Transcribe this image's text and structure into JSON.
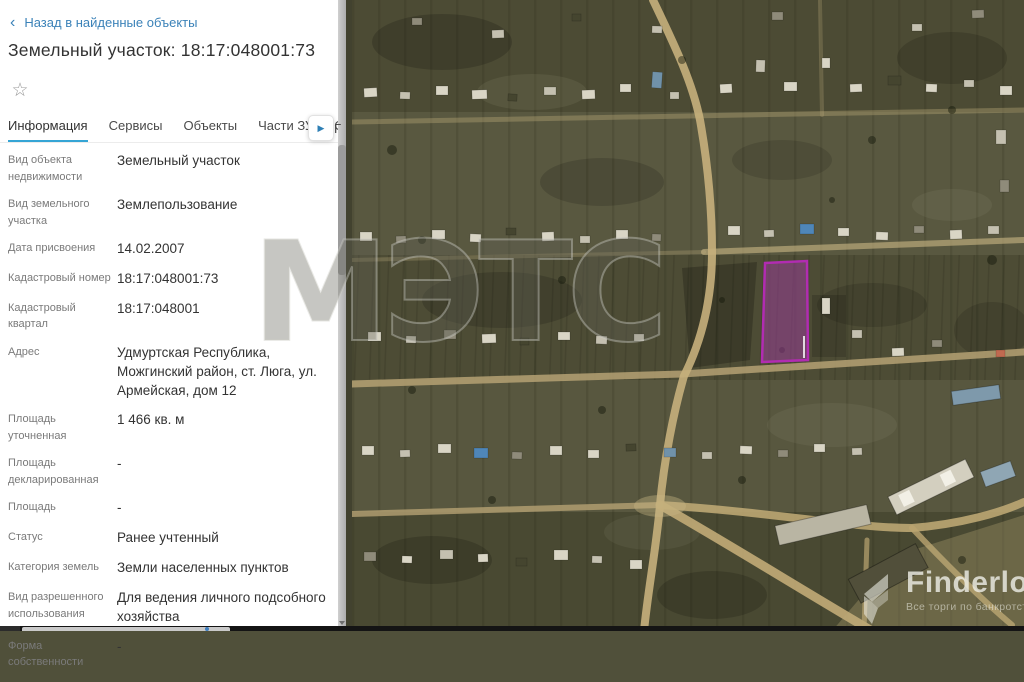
{
  "panel": {
    "back_link": "Назад в найденные объекты",
    "title": "Земельный участок: 18:17:048001:73",
    "tabs": [
      {
        "label": "Информация"
      },
      {
        "label": "Сервисы"
      },
      {
        "label": "Объекты"
      },
      {
        "label": "Части ЗУ"
      },
      {
        "label": "Соста"
      },
      {
        "label": "Г"
      }
    ],
    "fields": [
      {
        "label": "Вид объекта недвижимости",
        "value": "Земельный участок"
      },
      {
        "label": "Вид земельного участка",
        "value": "Землепользование"
      },
      {
        "label": "Дата присвоения",
        "value": "14.02.2007"
      },
      {
        "label": "Кадастровый номер",
        "value": "18:17:048001:73"
      },
      {
        "label": "Кадастровый квартал",
        "value": "18:17:048001"
      },
      {
        "label": "Адрес",
        "value": "Удмуртская Республика, Можгинский район, ст. Люга, ул. Армейская, дом 12"
      },
      {
        "label": "Площадь уточненная",
        "value": "1 466 кв. м"
      },
      {
        "label": "Площадь декларированная",
        "value": "-"
      },
      {
        "label": "Площадь",
        "value": "-"
      },
      {
        "label": "Статус",
        "value": "Ранее учтенный"
      },
      {
        "label": "Категория земель",
        "value": "Земли населенных пунктов"
      },
      {
        "label": "Вид разрешенного использования",
        "value": "Для ведения личного подсобного хозяйства"
      },
      {
        "label": "Форма собственности",
        "value": "-"
      }
    ]
  },
  "icons": {
    "back_chevron": "‹",
    "star": "☆",
    "tabs_arrow": "▶"
  },
  "watermarks": {
    "center": "МЭТС",
    "brand_name": "Finderlot",
    "brand_tagline": "Все торги по банкротству"
  },
  "map": {
    "highlight_parcel_number": "18:17:048001:73",
    "highlight_parcel_color": "#b12cb1",
    "accent_blue": "#3b82b8",
    "tab_underline_color": "#35a5d5",
    "map_base_color": "#50503a",
    "road_color": "#b9a473"
  }
}
